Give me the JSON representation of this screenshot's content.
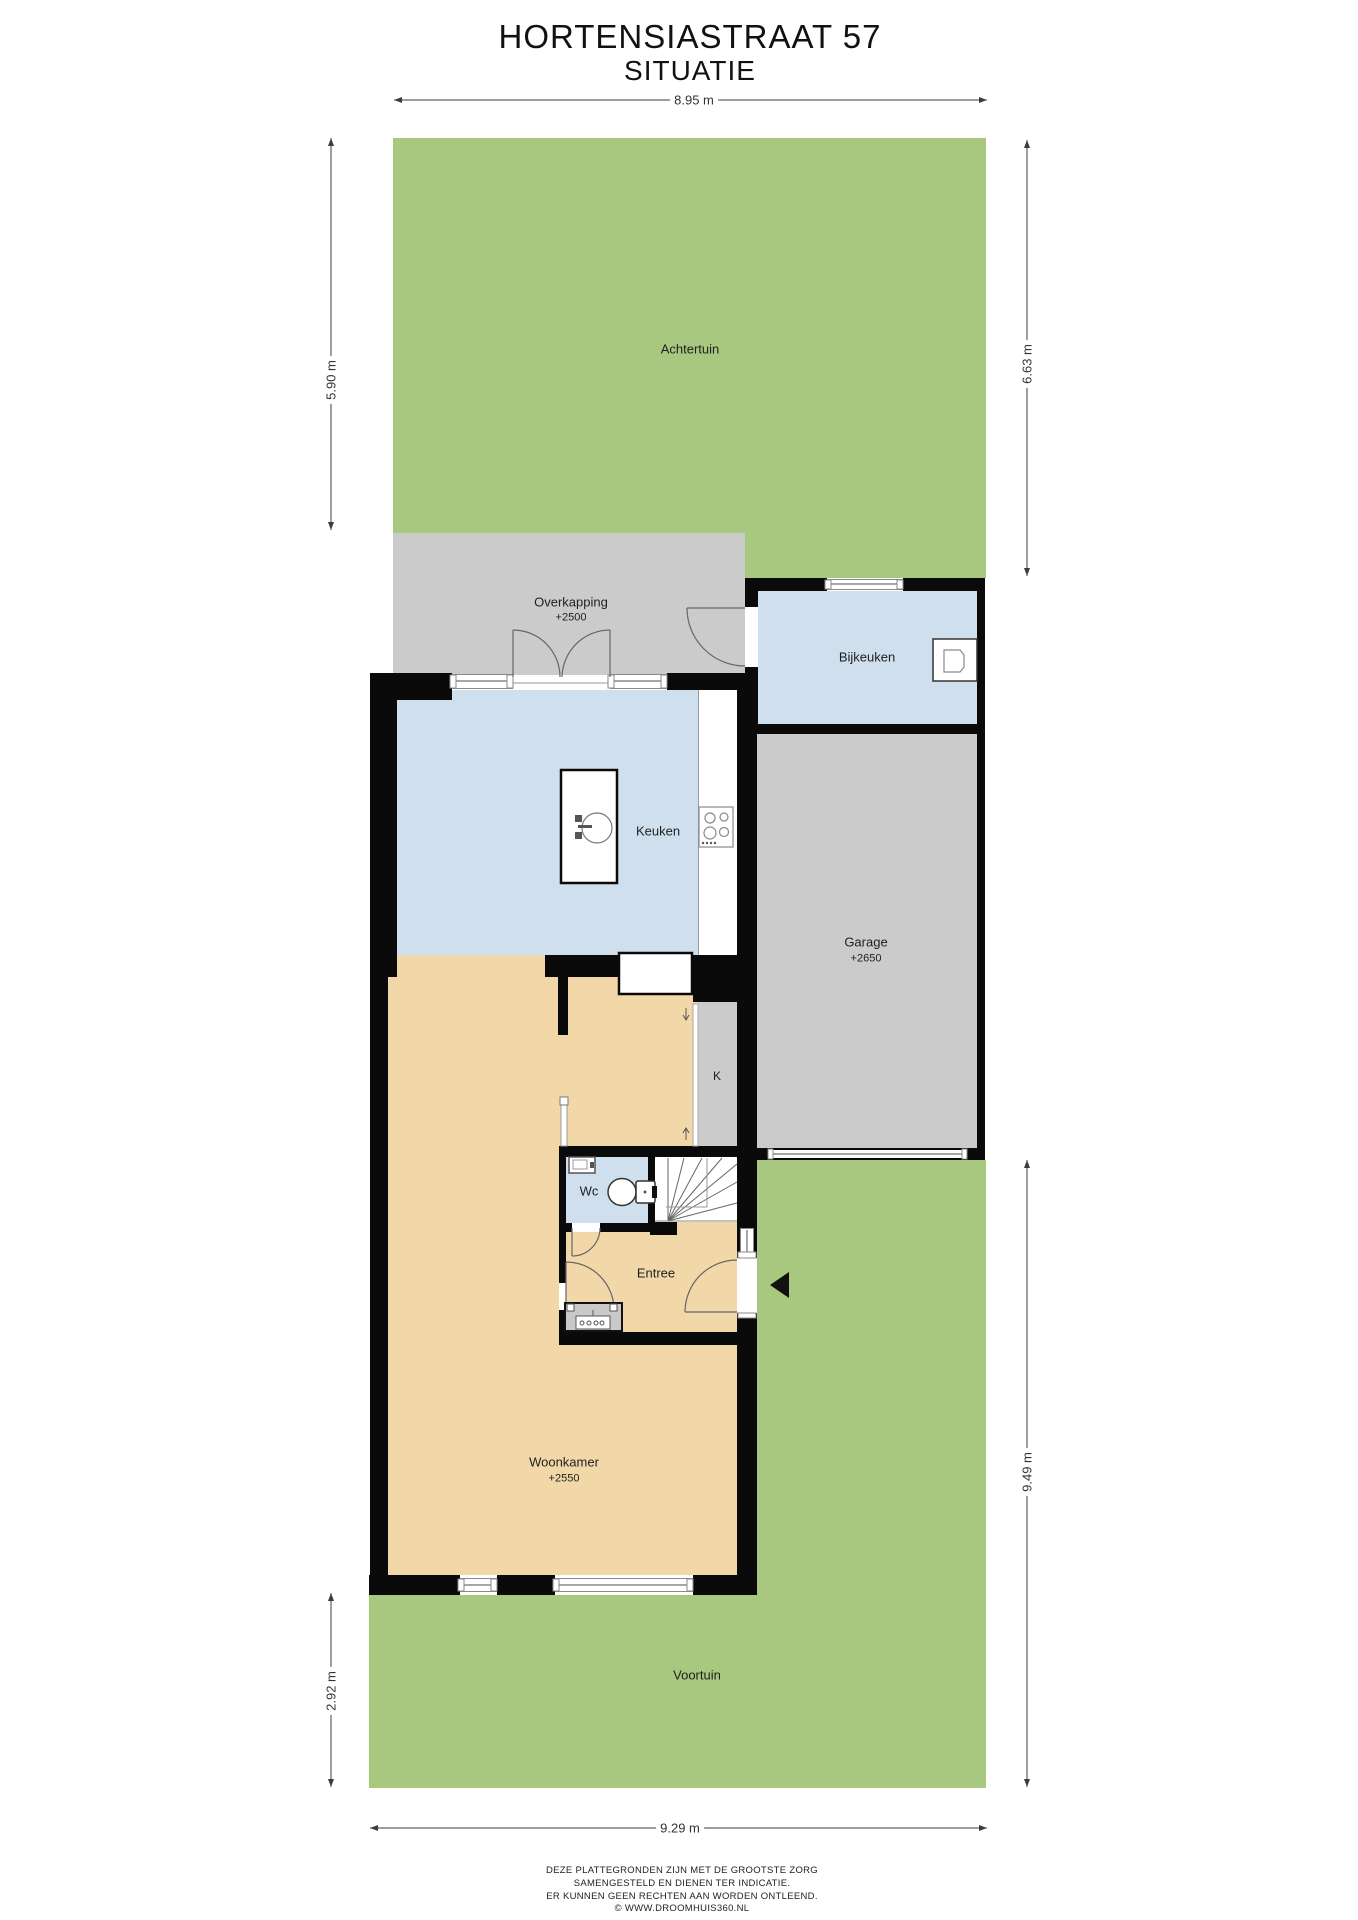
{
  "title": {
    "line1": "HORTENSIASTRAAT 57",
    "line2": "SITUATIE"
  },
  "dimensions": {
    "top": "8.95 m",
    "left_upper": "5.90 m",
    "left_lower": "2.92 m",
    "right_upper": "6.63 m",
    "right_lower": "9.49 m",
    "bottom": "9.29 m"
  },
  "rooms": {
    "achtertuin": {
      "name": "Achtertuin"
    },
    "overkapping": {
      "name": "Overkapping",
      "height": "+2500"
    },
    "bijkeuken": {
      "name": "Bijkeuken"
    },
    "keuken": {
      "name": "Keuken"
    },
    "garage": {
      "name": "Garage",
      "height": "+2650"
    },
    "k": {
      "name": "K"
    },
    "wc": {
      "name": "Wc"
    },
    "entree": {
      "name": "Entree"
    },
    "woonkamer": {
      "name": "Woonkamer",
      "height": "+2550"
    },
    "voortuin": {
      "name": "Voortuin"
    }
  },
  "footer": {
    "line1": "DEZE PLATTEGRONDEN ZIJN MET DE GROOTSTE ZORG",
    "line2": "SAMENGESTELD EN DIENEN TER INDICATIE.",
    "line3": "ER KUNNEN GEEN RECHTEN AAN WORDEN ONTLEEND.",
    "line4": "© WWW.DROOMHUIS360.NL"
  },
  "colors": {
    "green": "#a7c87e",
    "grey": "#cbcbcb",
    "blue": "#cfdfee",
    "tan": "#f2d8a9",
    "wall": "#0a0a0a",
    "line": "#3c3c3c",
    "fixture": "#777777",
    "text": "#1f1f1f"
  }
}
